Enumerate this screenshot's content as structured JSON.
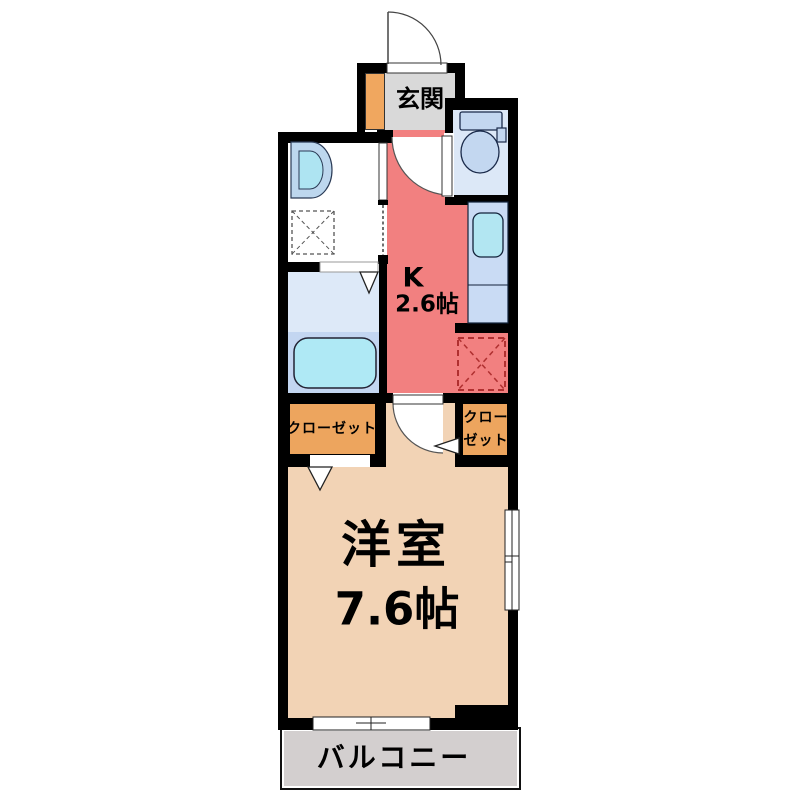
{
  "plan": {
    "type": "apartment-floor-plan",
    "rooms": {
      "genkan": {
        "label": "玄関",
        "floor_color": "#D9D9D9"
      },
      "kitchen": {
        "label": "K",
        "size": "2.6帖",
        "floor_color": "#F28080"
      },
      "toilet": {
        "floor_color": "#DCE8F7"
      },
      "washroom": {
        "floor_color": "#FFFFFF"
      },
      "bathroom": {
        "floor_color": "#C3D6F1",
        "floor_color_upper": "#DDE9F8"
      },
      "closet_left": {
        "label": "クローゼット",
        "floor_color": "#EDA55E"
      },
      "closet_right": {
        "label_line1": "クロー",
        "label_line2": "ゼット",
        "floor_color": "#EDA55E"
      },
      "living": {
        "label": "洋室",
        "size": "7.6帖",
        "floor_color": "#F2D3B5"
      },
      "balcony": {
        "label": "バルコニー",
        "floor_color": "#D3CFCF"
      }
    },
    "colors": {
      "wall": "#000000",
      "fixture_fill": "#C3D7F0",
      "fixture_cyan": "#AFE9F5",
      "counter_blue": "#C9DBF4",
      "shoe_cabinet_orange": "#F0A75F",
      "refrigerator_dash_red": "#B03030"
    },
    "fixture_icons": [
      "entrance-door-icon",
      "toilet-icon",
      "kitchen-sink-icon",
      "kitchen-counter-icon",
      "refrigerator-space-icon",
      "washbasin-icon",
      "washing-machine-space-icon",
      "bathtub-icon",
      "door-swing-icon",
      "sliding-window-icon",
      "balcony-sliding-door-icon",
      "folding-door-icon"
    ]
  }
}
